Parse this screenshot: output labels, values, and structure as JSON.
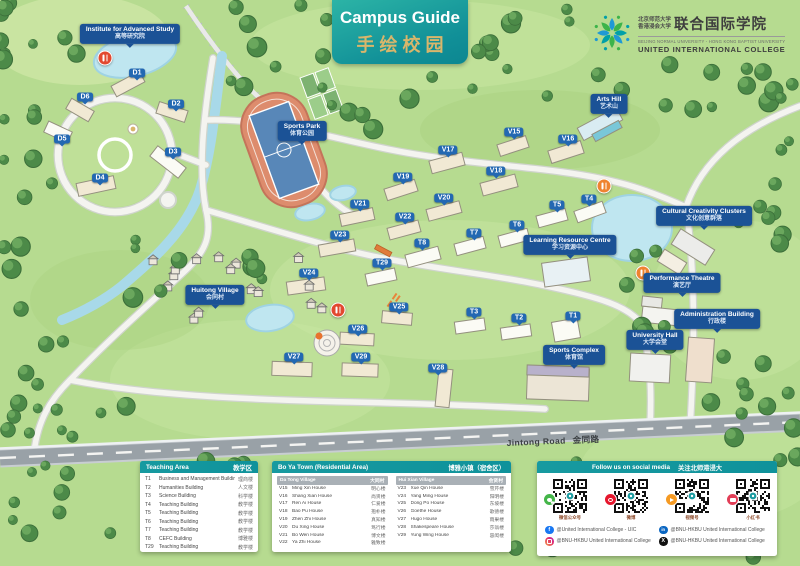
{
  "banner": {
    "title_en": "Campus Guide",
    "title_zh": "手绘校园"
  },
  "logo": {
    "cn_university_1": "北京师范大学",
    "cn_university_2": "香港浸会大学",
    "cn_college": "联合国际学院",
    "en_universities": "BEIJING NORMAL UNIVERSITY - HONG KONG BAPTIST UNIVERSITY",
    "en_college": "UNITED INTERNATIONAL COLLEGE"
  },
  "map": {
    "road_label_en": "Jintong Road",
    "road_label_zh": "金同路",
    "place_labels": [
      {
        "en": "Institute for Advanced Study",
        "zh": "高等研究院",
        "x": 130,
        "y": 34
      },
      {
        "en": "Sports Park",
        "zh": "体育公园",
        "x": 302,
        "y": 131
      },
      {
        "en": "Arts Hill",
        "zh": "艺术山",
        "x": 609,
        "y": 104
      },
      {
        "en": "Cultural Creativity Clusters",
        "zh": "文化创意群落",
        "x": 704,
        "y": 216
      },
      {
        "en": "Learning Resource Centre",
        "zh": "学习资源中心",
        "x": 570,
        "y": 245
      },
      {
        "en": "Performance Theatre",
        "zh": "演艺厅",
        "x": 682,
        "y": 283
      },
      {
        "en": "Administration Building",
        "zh": "行政楼",
        "x": 717,
        "y": 319
      },
      {
        "en": "University Hall",
        "zh": "大学会堂",
        "x": 655,
        "y": 340
      },
      {
        "en": "Sports Complex",
        "zh": "体育馆",
        "x": 574,
        "y": 355
      },
      {
        "en": "Huitong Village",
        "zh": "会同村",
        "x": 215,
        "y": 295
      }
    ],
    "building_tags": [
      {
        "id": "D1",
        "x": 137,
        "y": 73
      },
      {
        "id": "D2",
        "x": 176,
        "y": 104
      },
      {
        "id": "D3",
        "x": 173,
        "y": 152
      },
      {
        "id": "D4",
        "x": 100,
        "y": 178
      },
      {
        "id": "D5",
        "x": 62,
        "y": 139
      },
      {
        "id": "D6",
        "x": 85,
        "y": 97
      },
      {
        "id": "V15",
        "x": 514,
        "y": 132
      },
      {
        "id": "V16",
        "x": 568,
        "y": 139
      },
      {
        "id": "V17",
        "x": 448,
        "y": 150
      },
      {
        "id": "V18",
        "x": 496,
        "y": 171
      },
      {
        "id": "V19",
        "x": 403,
        "y": 177
      },
      {
        "id": "V20",
        "x": 444,
        "y": 198
      },
      {
        "id": "V21",
        "x": 360,
        "y": 204
      },
      {
        "id": "V22",
        "x": 405,
        "y": 217
      },
      {
        "id": "V23",
        "x": 340,
        "y": 235
      },
      {
        "id": "V24",
        "x": 309,
        "y": 273
      },
      {
        "id": "V25",
        "x": 399,
        "y": 307
      },
      {
        "id": "V26",
        "x": 358,
        "y": 329
      },
      {
        "id": "V27",
        "x": 294,
        "y": 357
      },
      {
        "id": "V28",
        "x": 438,
        "y": 368
      },
      {
        "id": "V29",
        "x": 361,
        "y": 357
      },
      {
        "id": "T1",
        "x": 573,
        "y": 316
      },
      {
        "id": "T2",
        "x": 519,
        "y": 318
      },
      {
        "id": "T3",
        "x": 474,
        "y": 312
      },
      {
        "id": "T4",
        "x": 589,
        "y": 199
      },
      {
        "id": "T5",
        "x": 557,
        "y": 205
      },
      {
        "id": "T6",
        "x": 517,
        "y": 225
      },
      {
        "id": "T7",
        "x": 474,
        "y": 233
      },
      {
        "id": "T8",
        "x": 422,
        "y": 243
      },
      {
        "id": "T29",
        "x": 382,
        "y": 263
      }
    ],
    "food_icons": [
      {
        "x": 105,
        "y": 58,
        "color": "#e2482f"
      },
      {
        "x": 604,
        "y": 186,
        "color": "#ef8330"
      },
      {
        "x": 643,
        "y": 273,
        "color": "#ef8330"
      },
      {
        "x": 338,
        "y": 310,
        "color": "#e2482f"
      }
    ]
  },
  "legend": {
    "teaching": {
      "title_en": "Teaching Area",
      "title_zh": "教学区",
      "rows": [
        {
          "code": "T1",
          "en": "Business and Management Building",
          "zh": "理商楼"
        },
        {
          "code": "T2",
          "en": "Humanities Building",
          "zh": "人文楼"
        },
        {
          "code": "T3",
          "en": "Science Building",
          "zh": "科学楼"
        },
        {
          "code": "T4",
          "en": "Teaching Building",
          "zh": "教学楼"
        },
        {
          "code": "T5",
          "en": "Teaching Building",
          "zh": "教学楼"
        },
        {
          "code": "T6",
          "en": "Teaching Building",
          "zh": "教学楼"
        },
        {
          "code": "T7",
          "en": "Teaching Building",
          "zh": "教学楼"
        },
        {
          "code": "T8",
          "en": "CEFC Building",
          "zh": "博雅楼"
        },
        {
          "code": "T29",
          "en": "Teaching Building",
          "zh": "教学楼"
        }
      ]
    },
    "boya": {
      "title_en": "Bo Ya Town (Residential Area)",
      "title_zh": "博雅小镇（宿舍区）",
      "villages": [
        {
          "name_en": "Da Tong Village",
          "name_zh": "大同村",
          "rows": [
            {
              "code": "V15",
              "en": "Ming Xin House",
              "zh": "明心楼"
            },
            {
              "code": "V16",
              "en": "Shang Xian House",
              "zh": "尚贤楼"
            },
            {
              "code": "V17",
              "en": "Ren Ai House",
              "zh": "仁爱楼"
            },
            {
              "code": "V18",
              "en": "Bao Pu House",
              "zh": "抱朴楼"
            },
            {
              "code": "V19",
              "en": "Zhen Zhi House",
              "zh": "真知楼"
            },
            {
              "code": "V20",
              "en": "Du Xing House",
              "zh": "笃行楼"
            },
            {
              "code": "V21",
              "en": "Bo Wen House",
              "zh": "博文楼"
            },
            {
              "code": "V22",
              "en": "Ya Zhi House",
              "zh": "雅致楼"
            }
          ]
        },
        {
          "name_en": "Hui Xian Village",
          "name_zh": "会贤村",
          "rows": [
            {
              "code": "V23",
              "en": "Xue Qin House",
              "zh": "雪芹楼"
            },
            {
              "code": "V24",
              "en": "Yang Ming House",
              "zh": "阳明楼"
            },
            {
              "code": "V25",
              "en": "Dong Po House",
              "zh": "东坡楼"
            },
            {
              "code": "V26",
              "en": "Goethe House",
              "zh": "歌德楼"
            },
            {
              "code": "V27",
              "en": "Hugo House",
              "zh": "雨果楼"
            },
            {
              "code": "V28",
              "en": "Shakespeare House",
              "zh": "莎翁楼"
            },
            {
              "code": "V29",
              "en": "Yung Wing House",
              "zh": "容闳楼"
            }
          ]
        }
      ]
    }
  },
  "social": {
    "title_en": "Follow us on social media",
    "title_zh": "关注北师港浸大",
    "qr_codes": [
      {
        "platform": "wechat",
        "caption": "微信公众号"
      },
      {
        "platform": "weibo",
        "caption": "微博"
      },
      {
        "platform": "wechat-channels",
        "caption": "视频号"
      },
      {
        "platform": "xiaohongshu",
        "caption": "小红书"
      }
    ],
    "accounts": [
      {
        "platform": "facebook",
        "handle": "@United International College - UIC"
      },
      {
        "platform": "linkedin",
        "handle": "@BNU-HKBU United International College"
      },
      {
        "platform": "instagram",
        "handle": "@BNU-HKBU United International College"
      },
      {
        "platform": "x",
        "handle": "@BNU-HKBU United International College"
      }
    ]
  },
  "colors": {
    "place_label_blue": "#1b5296",
    "building_tag_blue": "#2368b2",
    "header_teal": "#179aa0",
    "banner_gold": "#d9b66b"
  }
}
